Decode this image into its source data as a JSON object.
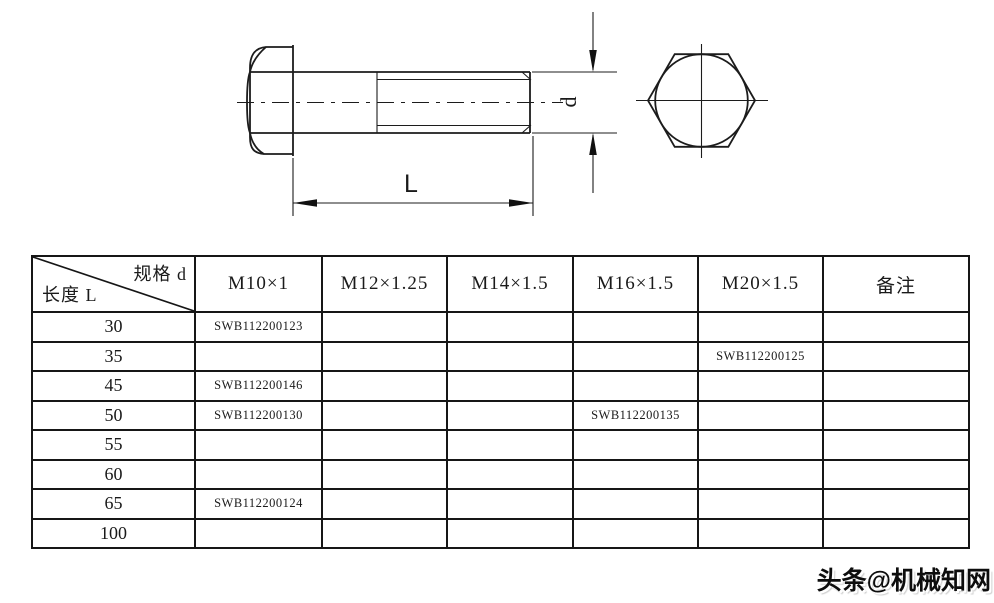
{
  "drawing": {
    "dim_length_label": "L",
    "dim_diameter_label": "d"
  },
  "table": {
    "corner": {
      "top_label": "规格  d",
      "bottom_label": "长度  L"
    },
    "columns": [
      "M10×1",
      "M12×1.25",
      "M14×1.5",
      "M16×1.5",
      "M20×1.5",
      "备注"
    ],
    "rows": [
      {
        "length": "30",
        "cells": [
          "SWB112200123",
          "",
          "",
          "",
          "",
          ""
        ]
      },
      {
        "length": "35",
        "cells": [
          "",
          "",
          "",
          "",
          "SWB112200125",
          ""
        ]
      },
      {
        "length": "45",
        "cells": [
          "SWB112200146",
          "",
          "",
          "",
          "",
          ""
        ]
      },
      {
        "length": "50",
        "cells": [
          "SWB112200130",
          "",
          "",
          "SWB112200135",
          "",
          ""
        ]
      },
      {
        "length": "55",
        "cells": [
          "",
          "",
          "",
          "",
          "",
          ""
        ]
      },
      {
        "length": "60",
        "cells": [
          "",
          "",
          "",
          "",
          "",
          ""
        ]
      },
      {
        "length": "65",
        "cells": [
          "SWB112200124",
          "",
          "",
          "",
          "",
          ""
        ]
      },
      {
        "length": "100",
        "cells": [
          "",
          "",
          "",
          "",
          "",
          ""
        ]
      }
    ]
  },
  "watermark": {
    "text": "头条@机械知网"
  },
  "colors": {
    "line": "#1c1c1c",
    "background": "#ffffff"
  }
}
